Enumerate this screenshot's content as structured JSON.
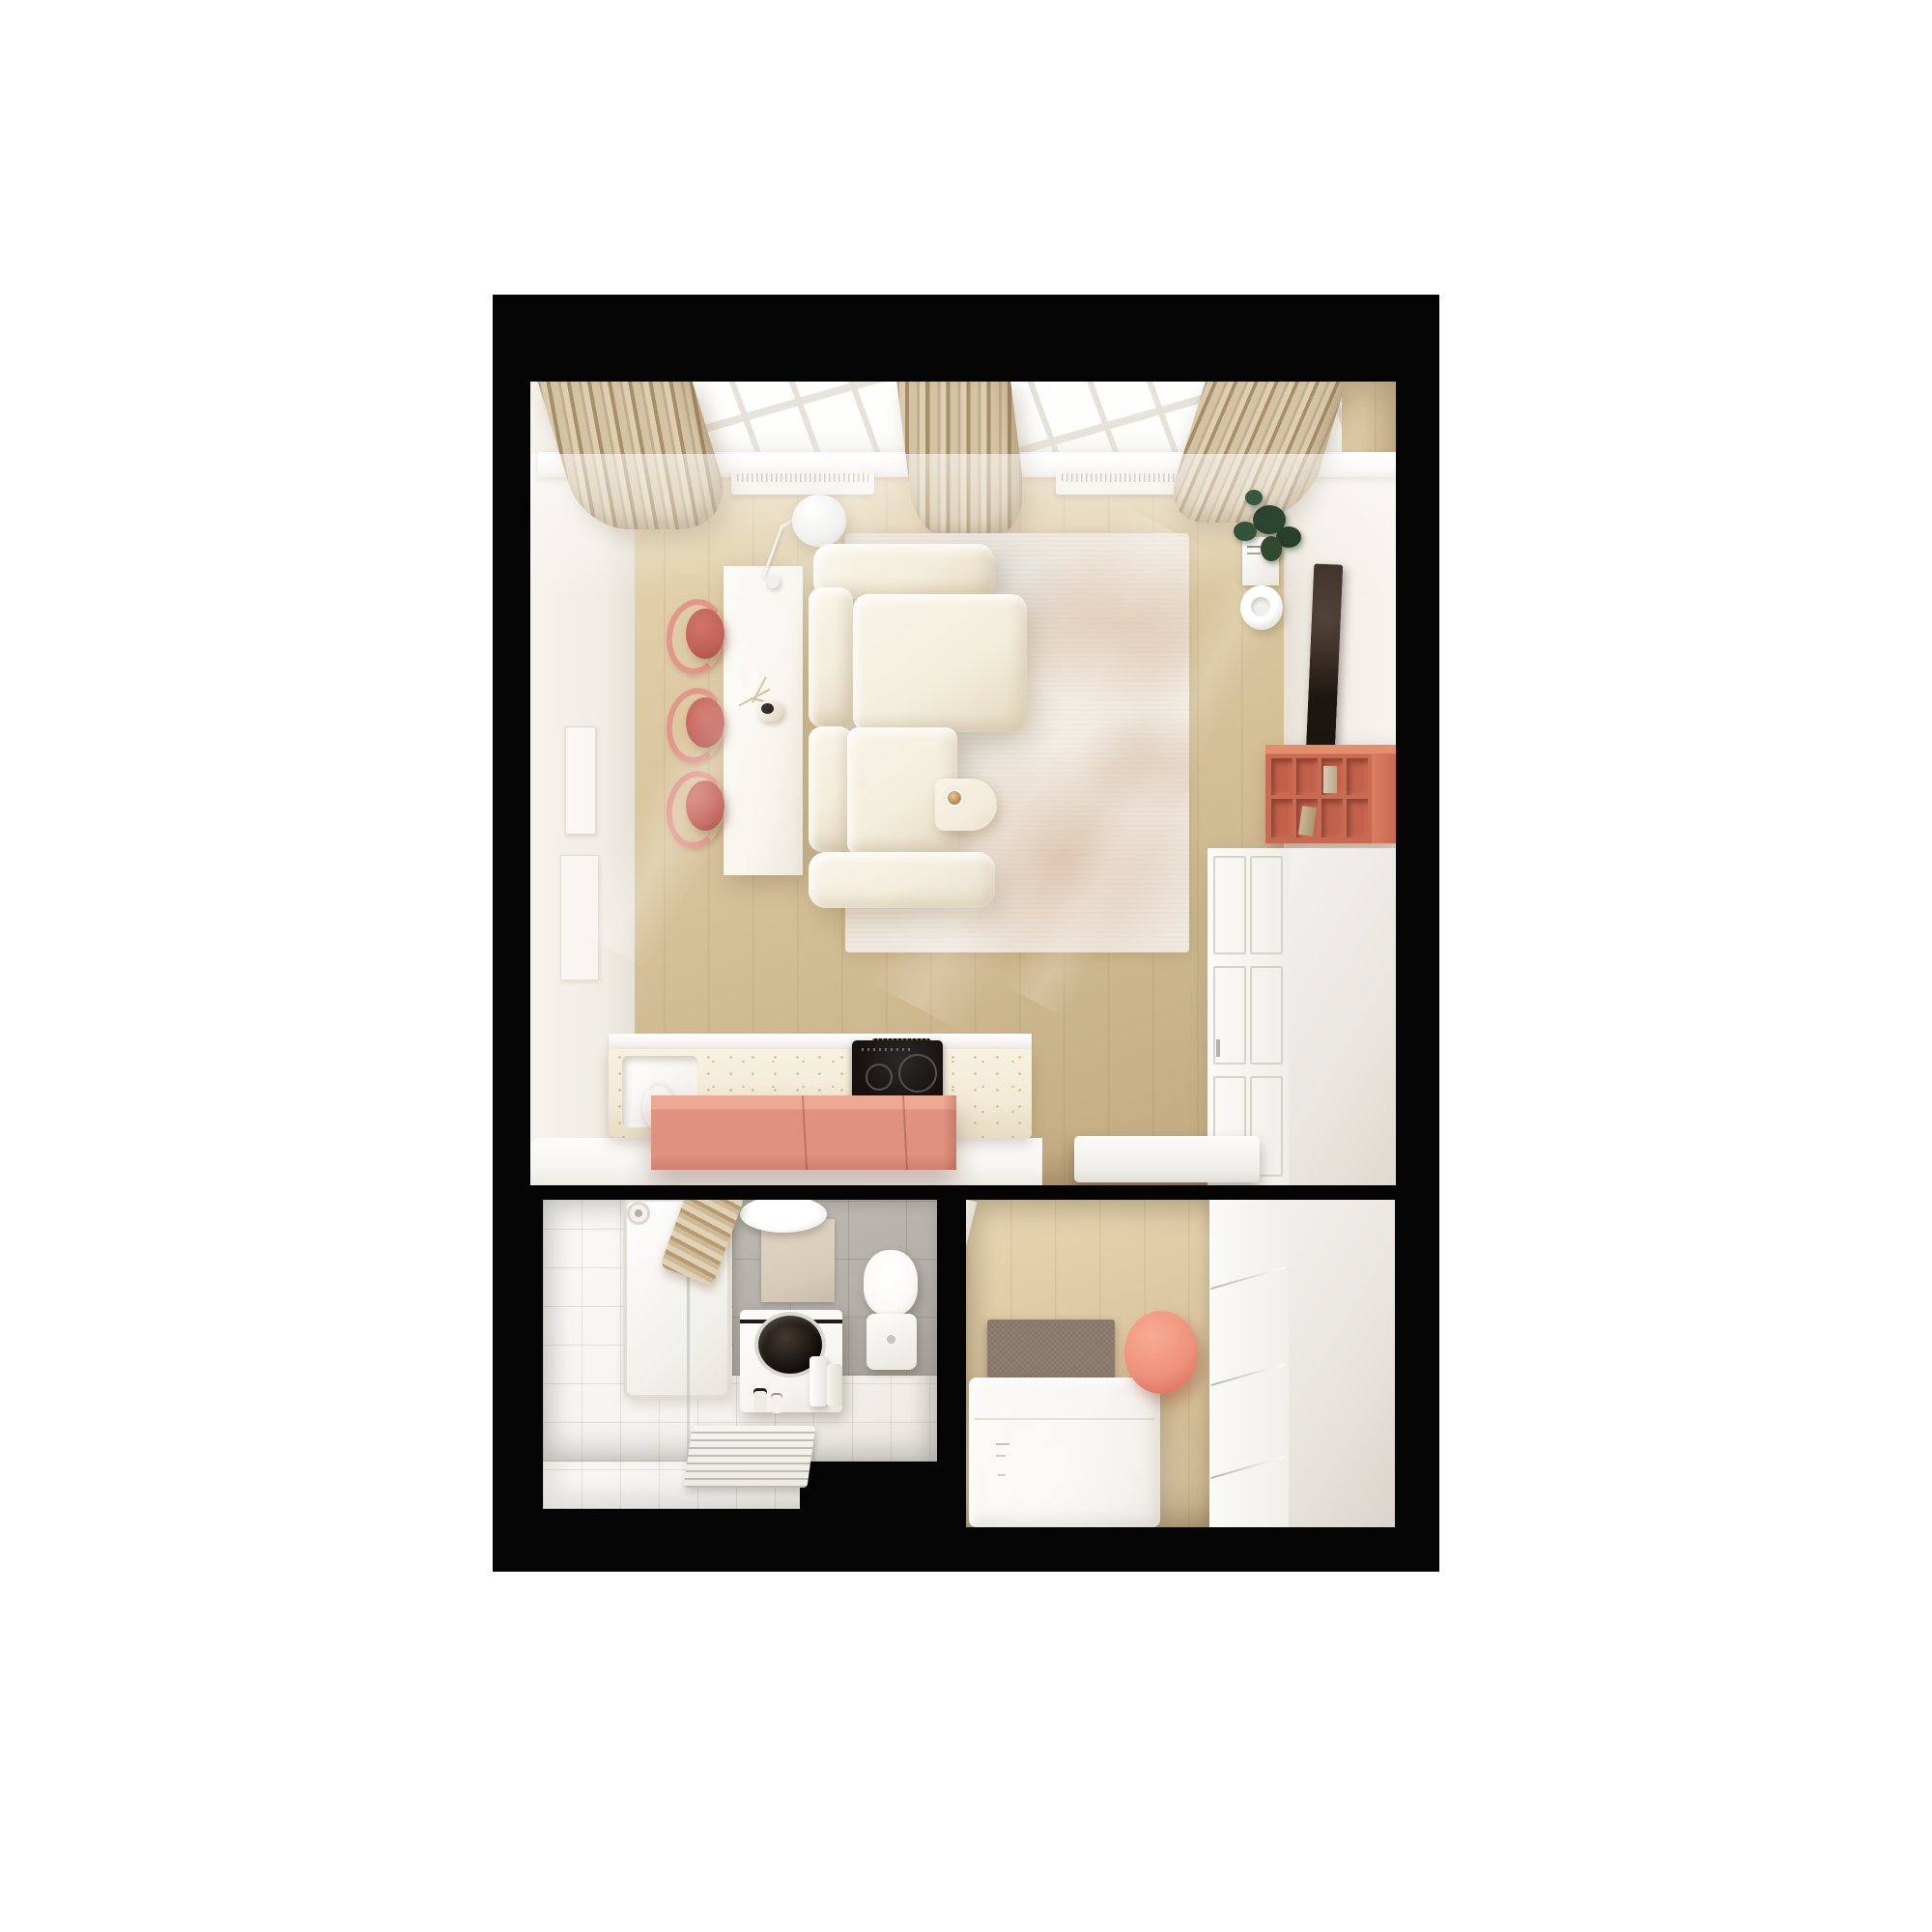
{
  "meta": {
    "type": "3d-floorplan-render",
    "view": "top-down",
    "description": "Top-down 3D render of a small studio apartment floor plan on a white background: living room with kitchen, bathroom, and bedroom framed by black walls"
  },
  "colors": {
    "page": "#ffffff",
    "wall": "#050505",
    "wood_light": "#e8d8b4",
    "wood_mid": "#d9c59d",
    "wood_dark": "#bfa67c",
    "wall_face": "#f1ece5",
    "curtain_light": "#ddcfb2",
    "curtain_mid": "#c3ad8c",
    "curtain_dark": "#a98e68",
    "pane": "#fdfdfa",
    "mullion": "#e6e2d9",
    "sill": "#f6f3ed",
    "radiator": "#f3efe7",
    "desk": "#f8f5ee",
    "stool_seat": "#bf5f57",
    "stool_frame": "#e2968c",
    "sofa": "#f4eedd",
    "sofa_shade": "#e3d8c0",
    "rug": "#efe9e0",
    "rug_rust": "#c18a5c",
    "rug_blue": "#aac8d2",
    "table": "#f3ecda",
    "coffee": "#b97e3e",
    "plant": "#2f4a33",
    "tv": "#1c1510",
    "shelf": "#c96a52",
    "shelf_dark": "#9c4633",
    "shelf_top": "#e58e6e",
    "island": "#e09180",
    "island_top": "#efa893",
    "cabinet": "#f4f2ee",
    "cabinet_side": "#e9e6e0",
    "terrazzo": "#f2ead6",
    "speck": "#c29a52",
    "hob": "#16120f",
    "floor_white": "#f7f6f2",
    "tile": "#f5f3ef",
    "gray_tile": "#b2aea8",
    "inset_beige": "#d7cbb8",
    "towel_light": "#e0d2b6",
    "towel_dark": "#b59a74",
    "washer": "#f7f6f3",
    "toilet": "#fbfaf7",
    "headboard": "#8b7b6d",
    "duvet": "#f8f6f2",
    "pouf": "#ee927c",
    "wardrobe_side": "#e7e4de",
    "glass": "#aab4b6"
  },
  "apartment": {
    "rooms": [
      {
        "id": "living-kitchen",
        "label": "Living room with open kitchen",
        "items": [
          "skylight windows",
          "three beige curtains",
          "two radiators",
          "two wall artworks",
          "floor lamp",
          "white console desk",
          "three coral stools",
          "vase with branches",
          "cream corner sofa",
          "abstract beige rug",
          "side table with coffee cup",
          "potted plant on books",
          "round wall bowl",
          "tv panel",
          "coral cube shelf",
          "white panel cabinet",
          "terrazzo kitchen counter with sink",
          "induction hob",
          "coral kitchen island",
          "white entry bench"
        ]
      },
      {
        "id": "bathroom",
        "label": "Bathroom",
        "items": [
          "shower tray with glass screen",
          "shower head",
          "towel ladder",
          "round basin mirror",
          "gray tiled wall with beige inset",
          "top-load washing machine",
          "detergent bottles",
          "toilet",
          "slatted bath mat"
        ]
      },
      {
        "id": "bedroom",
        "label": "Bedroom",
        "items": [
          "bed with gray fabric headboard",
          "white duvet",
          "coral round pouf",
          "white wardrobe with drawers"
        ]
      }
    ]
  }
}
